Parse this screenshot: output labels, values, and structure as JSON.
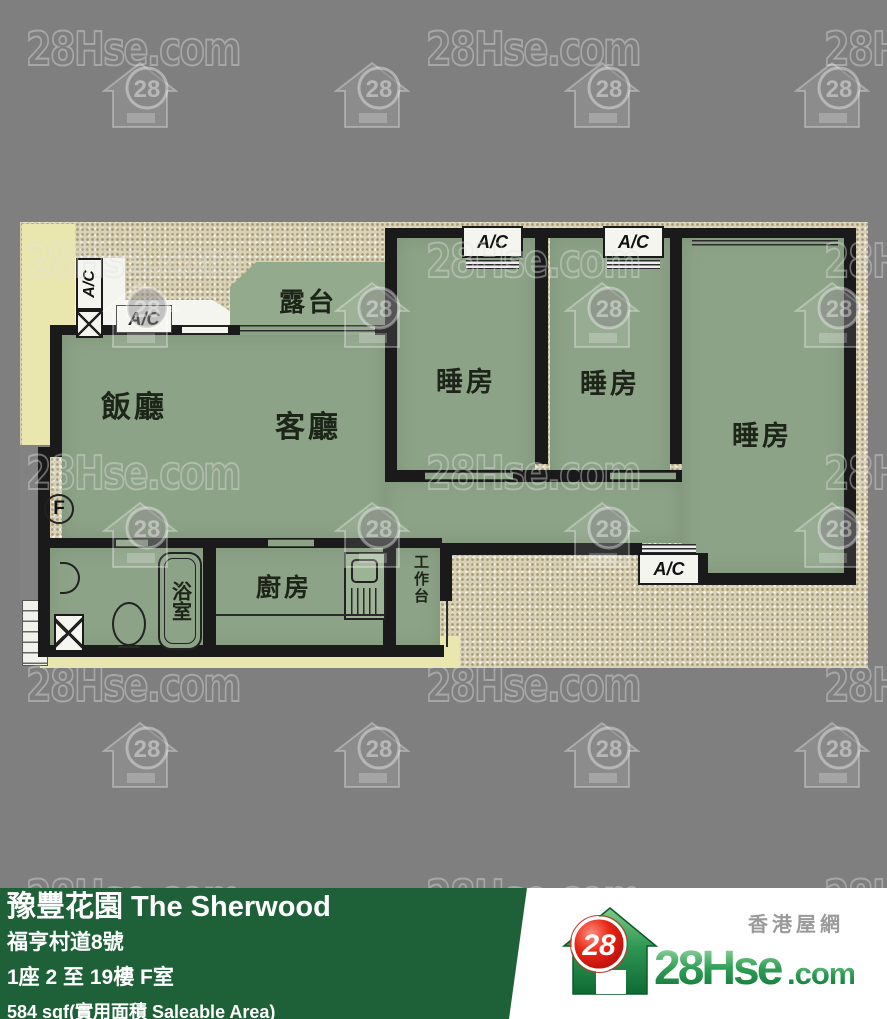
{
  "watermark": {
    "text": "28Hse.com",
    "icon_number": "28"
  },
  "floor_plan": {
    "unit_marker": "F",
    "ac_label": "A/C",
    "rooms": {
      "dining": "飯廳",
      "living": "客廳",
      "bedroom": "睡房",
      "balcony": "露台",
      "kitchen": "廚房",
      "bathroom": "浴室",
      "worktop": "工作台"
    }
  },
  "info_bar": {
    "building_name": "豫豐花園 The Sherwood",
    "address": "福亨村道8號",
    "floor_unit": "1座 2 至 19樓 F室",
    "area": "584 sqf(實用面積 Saleable Area)"
  },
  "logo": {
    "badge": "28",
    "name_main": "28Hse",
    "name_suffix": ".com",
    "tagline": "香港屋網"
  },
  "colors": {
    "background": "#7f7f7f",
    "bar_green": "#1e6138",
    "room_green": "#8da387",
    "plan_beige": "#d8d1b6",
    "pale_yellow": "#e9e6ae",
    "wall_black": "#1a1a1a",
    "logo_red": "#d61212",
    "logo_green": "#147a3e"
  }
}
